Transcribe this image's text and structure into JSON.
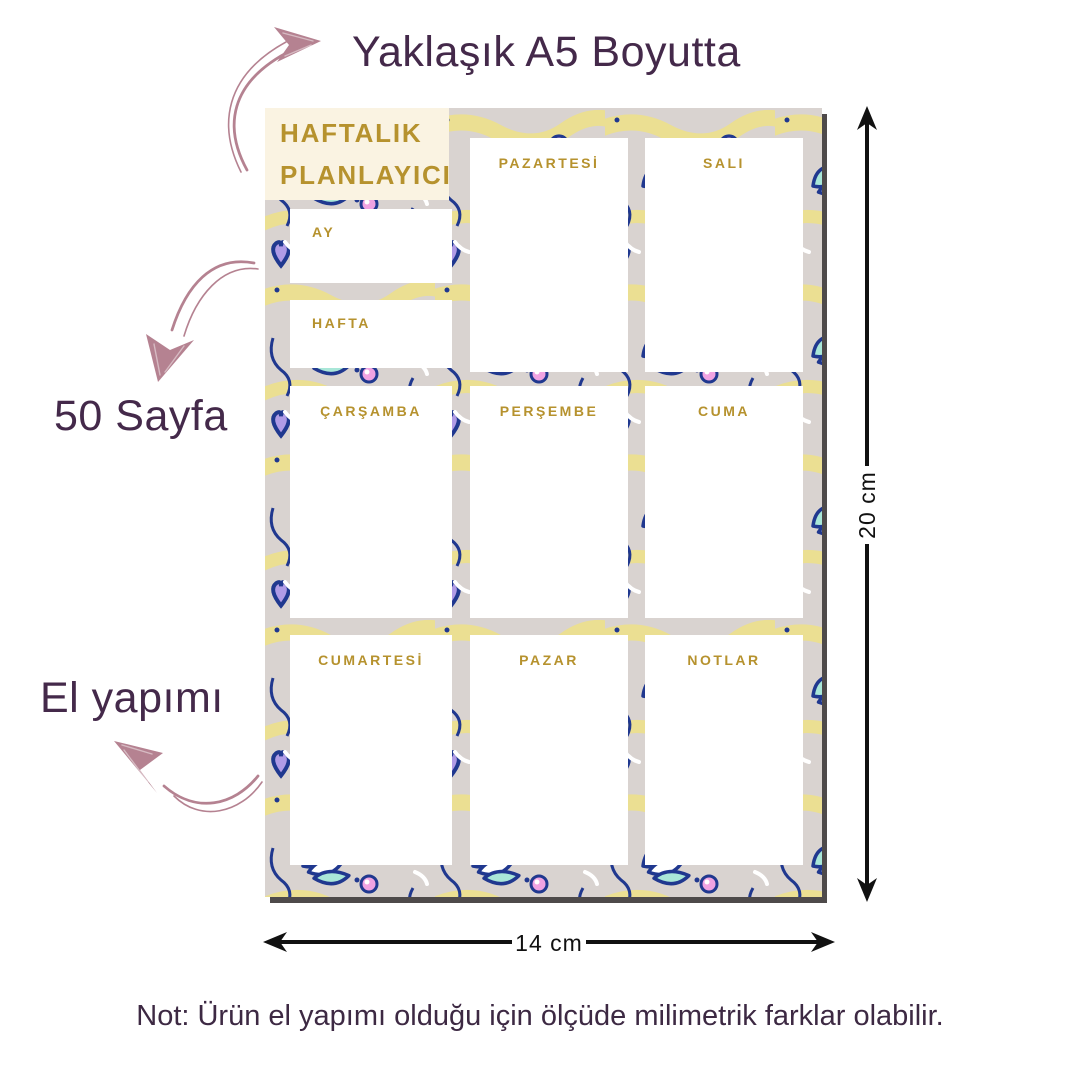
{
  "page": {
    "top_caption": "Yaklaşık A5 Boyutta",
    "page_count_caption": "50 Sayfa",
    "handmade_caption": "El yapımı",
    "bottom_note": "Not: Ürün el yapımı olduğu için ölçüde milimetrik farklar olabilir.",
    "height_dimension": "20 cm",
    "width_dimension": "14 cm"
  },
  "planner": {
    "title_line1": "HAFTALIK",
    "title_line2": "PLANLAYICI",
    "month_label": "AY",
    "week_label": "HAFTA",
    "cells": {
      "monday": "PAZARTESİ",
      "tuesday": "SALI",
      "wednesday": "ÇARŞAMBA",
      "thursday": "PERŞEMBE",
      "friday": "CUMA",
      "saturday": "CUMARTESİ",
      "sunday": "PAZAR",
      "notes": "NOTLAR"
    }
  },
  "colors": {
    "caption_text": "#44294a",
    "note_text": "#3d2943",
    "gold_text": "#b6922e",
    "cream_card": "#faf3e2",
    "sketch_arrow": "#b58291",
    "dimension_arrow": "#111111",
    "planner_shadow": "#4e4a4a",
    "pattern_navy": "#20388f",
    "pattern_pink": "#f0a3e2",
    "pattern_lavender": "#b09be6",
    "pattern_mint": "#a9e7d8",
    "pattern_yellow": "#ebdf92",
    "pattern_background": "#d9d3d0"
  }
}
